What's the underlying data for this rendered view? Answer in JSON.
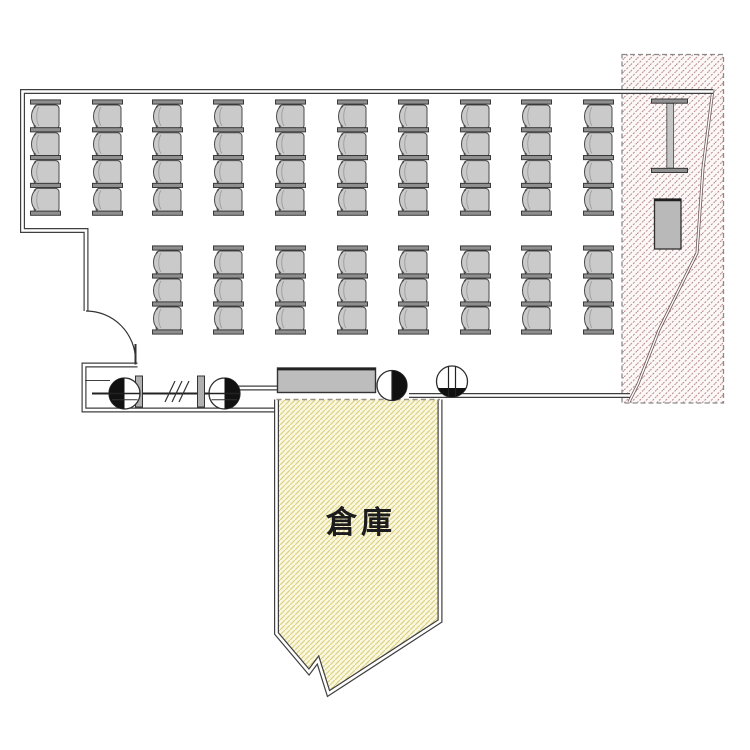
{
  "page": {
    "background": "#ffffff",
    "drawing_type": "room floor plan"
  },
  "labels": {
    "storage_room": "倉庫"
  },
  "colors": {
    "wall": "#3f3f3f",
    "seat_fill": "#cacaca",
    "seat_bar": "#8f8f8f",
    "seat_outline": "#4a4a4a",
    "table_fill": "#bdbdbd",
    "restricted_hatch_line": "#bb8f8f",
    "restricted_hatch_bg": "#fdf8f8",
    "restricted_border": "#8b8b8b",
    "storage_hatch_line": "#ded187",
    "storage_hatch_bg": "#fbf8e0",
    "fixture_black": "#111111"
  },
  "seating": {
    "total_chairs": 64,
    "blocks": [
      {
        "id": "back-block",
        "columns": 10,
        "chairs_per_column": 4,
        "column_x": [
          30,
          92,
          152,
          213,
          275,
          337,
          398,
          460,
          521,
          583
        ],
        "y_top": 102,
        "chair_width": 31,
        "chair_height": 27.8
      },
      {
        "id": "front-block",
        "columns": 8,
        "chairs_per_column": 3,
        "column_x": [
          152,
          213,
          275,
          337,
          398,
          460,
          521,
          583
        ],
        "y_top": 248,
        "chair_width": 31,
        "chair_height": 28
      }
    ]
  },
  "fixtures": {
    "door": "swing-door",
    "table": "long-table",
    "rail": "rail-with-posts",
    "marker_left": "half-filled-circle-marker",
    "marker_right": "half-filled-circle-marker",
    "marker_center": "half-filled-circle-marker",
    "marker_striped": "striped-circle-marker",
    "steel_column": "h-beam-column",
    "cabinet": "equipment-cabinet",
    "restricted_area": "hatched-restricted-area",
    "pipe": "diagonal-pipe-run"
  }
}
